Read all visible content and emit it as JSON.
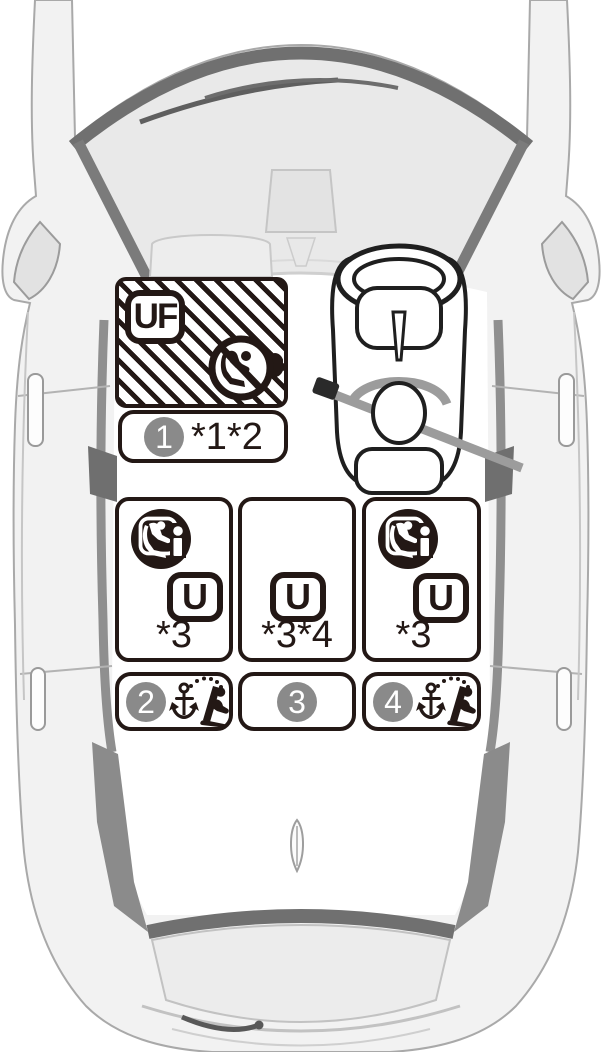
{
  "positions": {
    "front_passenger": {
      "seat_code": "UF",
      "badge_number": "1",
      "footnote": "*1*2"
    },
    "rear_left": {
      "seat_code": "U",
      "footnote": "*3",
      "badge_number": "2"
    },
    "rear_center": {
      "seat_code": "U",
      "footnote": "*3*4",
      "badge_number": "3"
    },
    "rear_right": {
      "seat_code": "U",
      "footnote": "*3",
      "badge_number": "4"
    }
  },
  "icons": {
    "front_passenger": [
      "no-rearward-facing-child-seat-airbag-icon"
    ],
    "rear_left": [
      "i-size-ready-icon",
      "top-tether-anchor-icon"
    ],
    "rear_center": [],
    "rear_right": [
      "i-size-ready-icon",
      "top-tether-anchor-icon"
    ]
  },
  "colors": {
    "ink": "#231815",
    "number_circle_gray": "#8a8a8a",
    "car_outline_gray": "#a9a9a9",
    "car_dark_trim": "#707070",
    "glass_gray": "#e9e9e9",
    "background": "#ffffff"
  }
}
